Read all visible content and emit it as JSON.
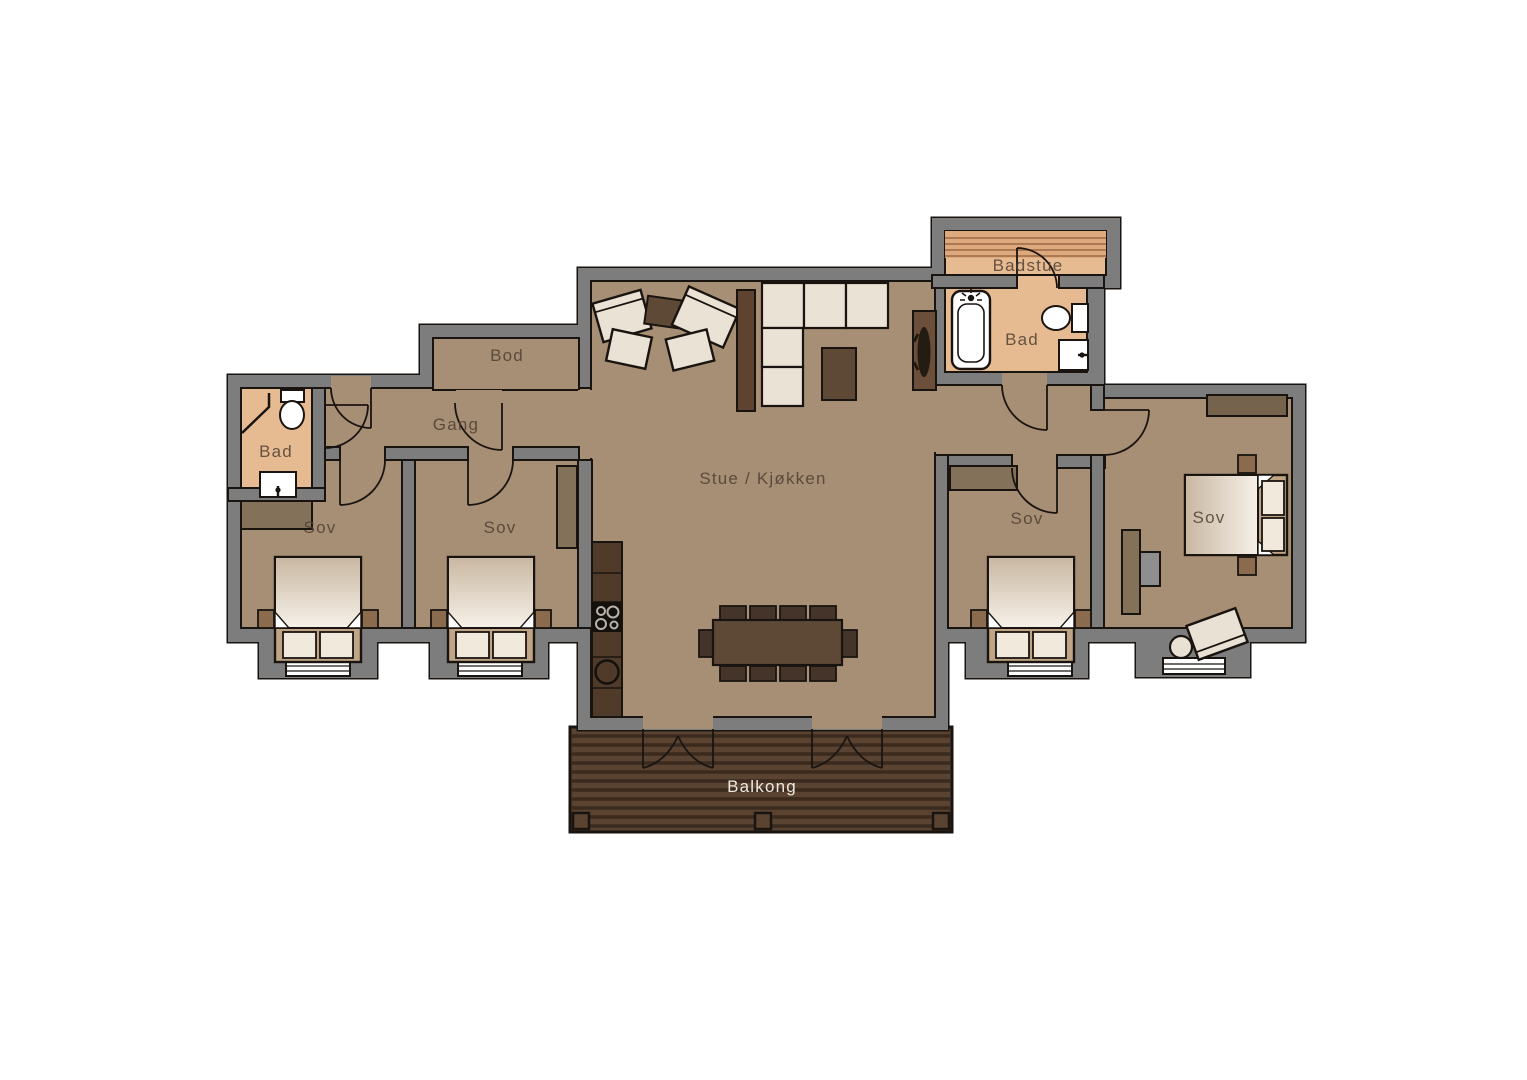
{
  "plan": {
    "title": "Floor plan with balcony",
    "rooms": [
      {
        "id": "bad-left",
        "label": "Bad"
      },
      {
        "id": "sov-1",
        "label": "Sov"
      },
      {
        "id": "sov-2",
        "label": "Sov"
      },
      {
        "id": "gang",
        "label": "Gang"
      },
      {
        "id": "bod",
        "label": "Bod"
      },
      {
        "id": "stue",
        "label": "Stue / Kjøkken"
      },
      {
        "id": "badstue",
        "label": "Badstue"
      },
      {
        "id": "bad-right",
        "label": "Bad"
      },
      {
        "id": "sov-3",
        "label": "Sov"
      },
      {
        "id": "sov-4",
        "label": "Sov"
      },
      {
        "id": "balkong",
        "label": "Balkong"
      }
    ],
    "colors": {
      "wall": "#7d7d7d",
      "outline": "#1a1410",
      "floor": "#a78f75",
      "bathroom_floor": "#e7bb92",
      "sauna_bench": "#dfa97e",
      "deck": "#5a4330",
      "deck_stripe": "#3a2b1e",
      "furniture_dark": "#5e4936",
      "furniture_darker": "#44342a",
      "wardrobe": "#84715a",
      "upholstery": "#eae2d4",
      "bed_duvet_from": "#c9b7a2",
      "bed_duvet_to": "#f6f1e8",
      "label_text": "#4e3f31",
      "deck_label_text": "#f6f2ea"
    },
    "fixtures": [
      "bathtub",
      "toilet",
      "sink",
      "shower-screen",
      "stove-burners",
      "kitchen-sink",
      "wood-stove",
      "sauna-bench"
    ]
  }
}
